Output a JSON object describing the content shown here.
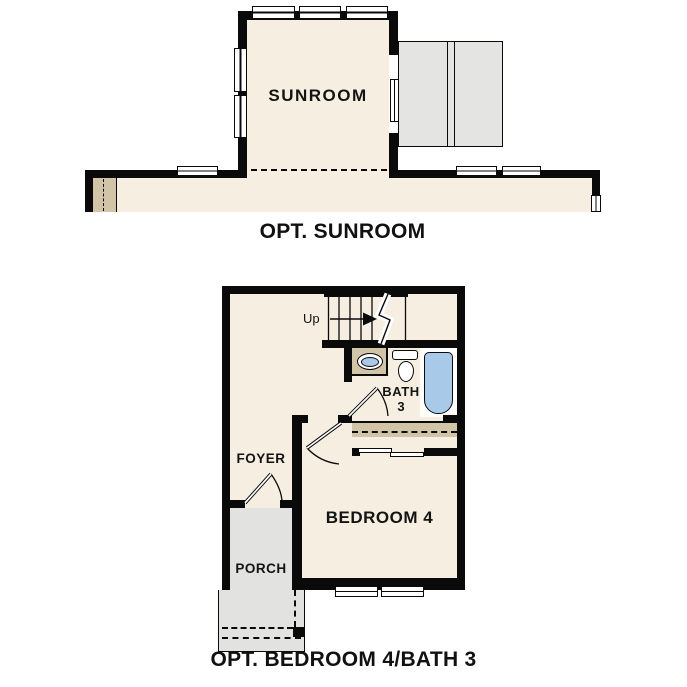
{
  "figure": {
    "type": "floor-plan-options",
    "colors": {
      "wall": "#0a0a0a",
      "floor_cream": "#f6eee1",
      "deck_gray": "#e4e4e2",
      "accent_tan": "#d2c4a7",
      "fixture_blue": "#a9c9e9"
    }
  },
  "plans": [
    {
      "title": "OPT. SUNROOM",
      "rooms": [
        {
          "label": "SUNROOM"
        }
      ]
    },
    {
      "title": "OPT. BEDROOM 4/BATH 3",
      "rooms": [
        {
          "label": "FOYER"
        },
        {
          "label": "BEDROOM 4"
        },
        {
          "label": "PORCH"
        }
      ],
      "bath": {
        "line1": "BATH",
        "line2": "3"
      },
      "stairs": {
        "label": "Up"
      }
    }
  ]
}
